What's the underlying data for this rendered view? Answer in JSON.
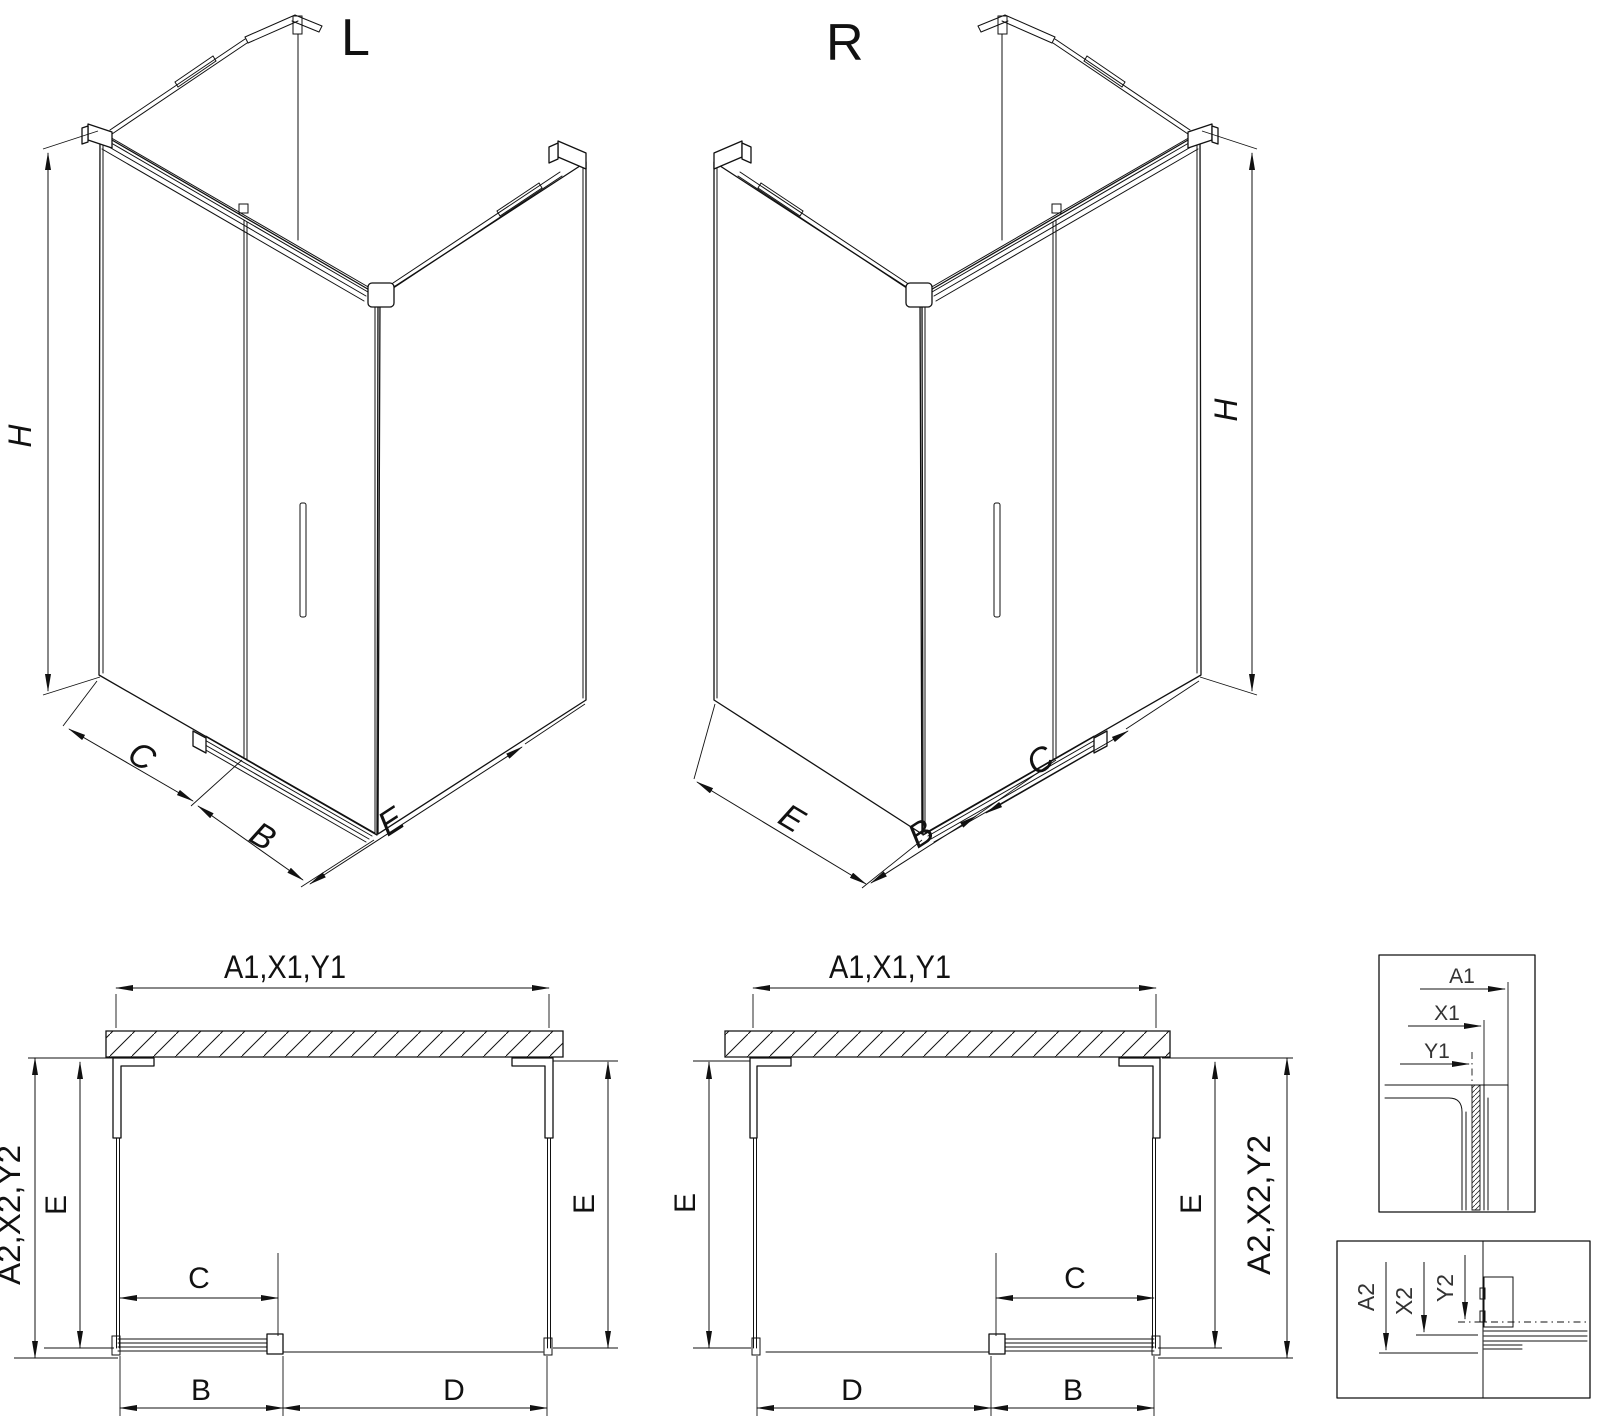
{
  "page": {
    "background": "#ffffff",
    "line_color": "#111111"
  },
  "iso_left": {
    "label": "L",
    "dim_height": "H",
    "dim_fixed": "C",
    "dim_door": "B",
    "dim_side": "E"
  },
  "iso_right": {
    "label": "R",
    "dim_height": "H",
    "dim_fixed": "C",
    "dim_door": "B",
    "dim_side": "E"
  },
  "plan_left": {
    "dim_width_top": "A1,X1,Y1",
    "dim_depth_overall": "A2,X2,Y2",
    "dim_depth_left": "E",
    "dim_depth_right": "E",
    "dim_door_glass": "C",
    "dim_door": "B",
    "dim_fixed": "D"
  },
  "plan_right": {
    "dim_width_top": "A1,X1,Y1",
    "dim_depth_overall": "A2,X2,Y2",
    "dim_depth_left": "E",
    "dim_depth_right": "E",
    "dim_door_glass": "C",
    "dim_door": "B",
    "dim_fixed": "D"
  },
  "detail_width": {
    "dim_a": "A1",
    "dim_x": "X1",
    "dim_y": "Y1"
  },
  "detail_depth": {
    "dim_a": "A2",
    "dim_x": "X2",
    "dim_y": "Y2"
  }
}
